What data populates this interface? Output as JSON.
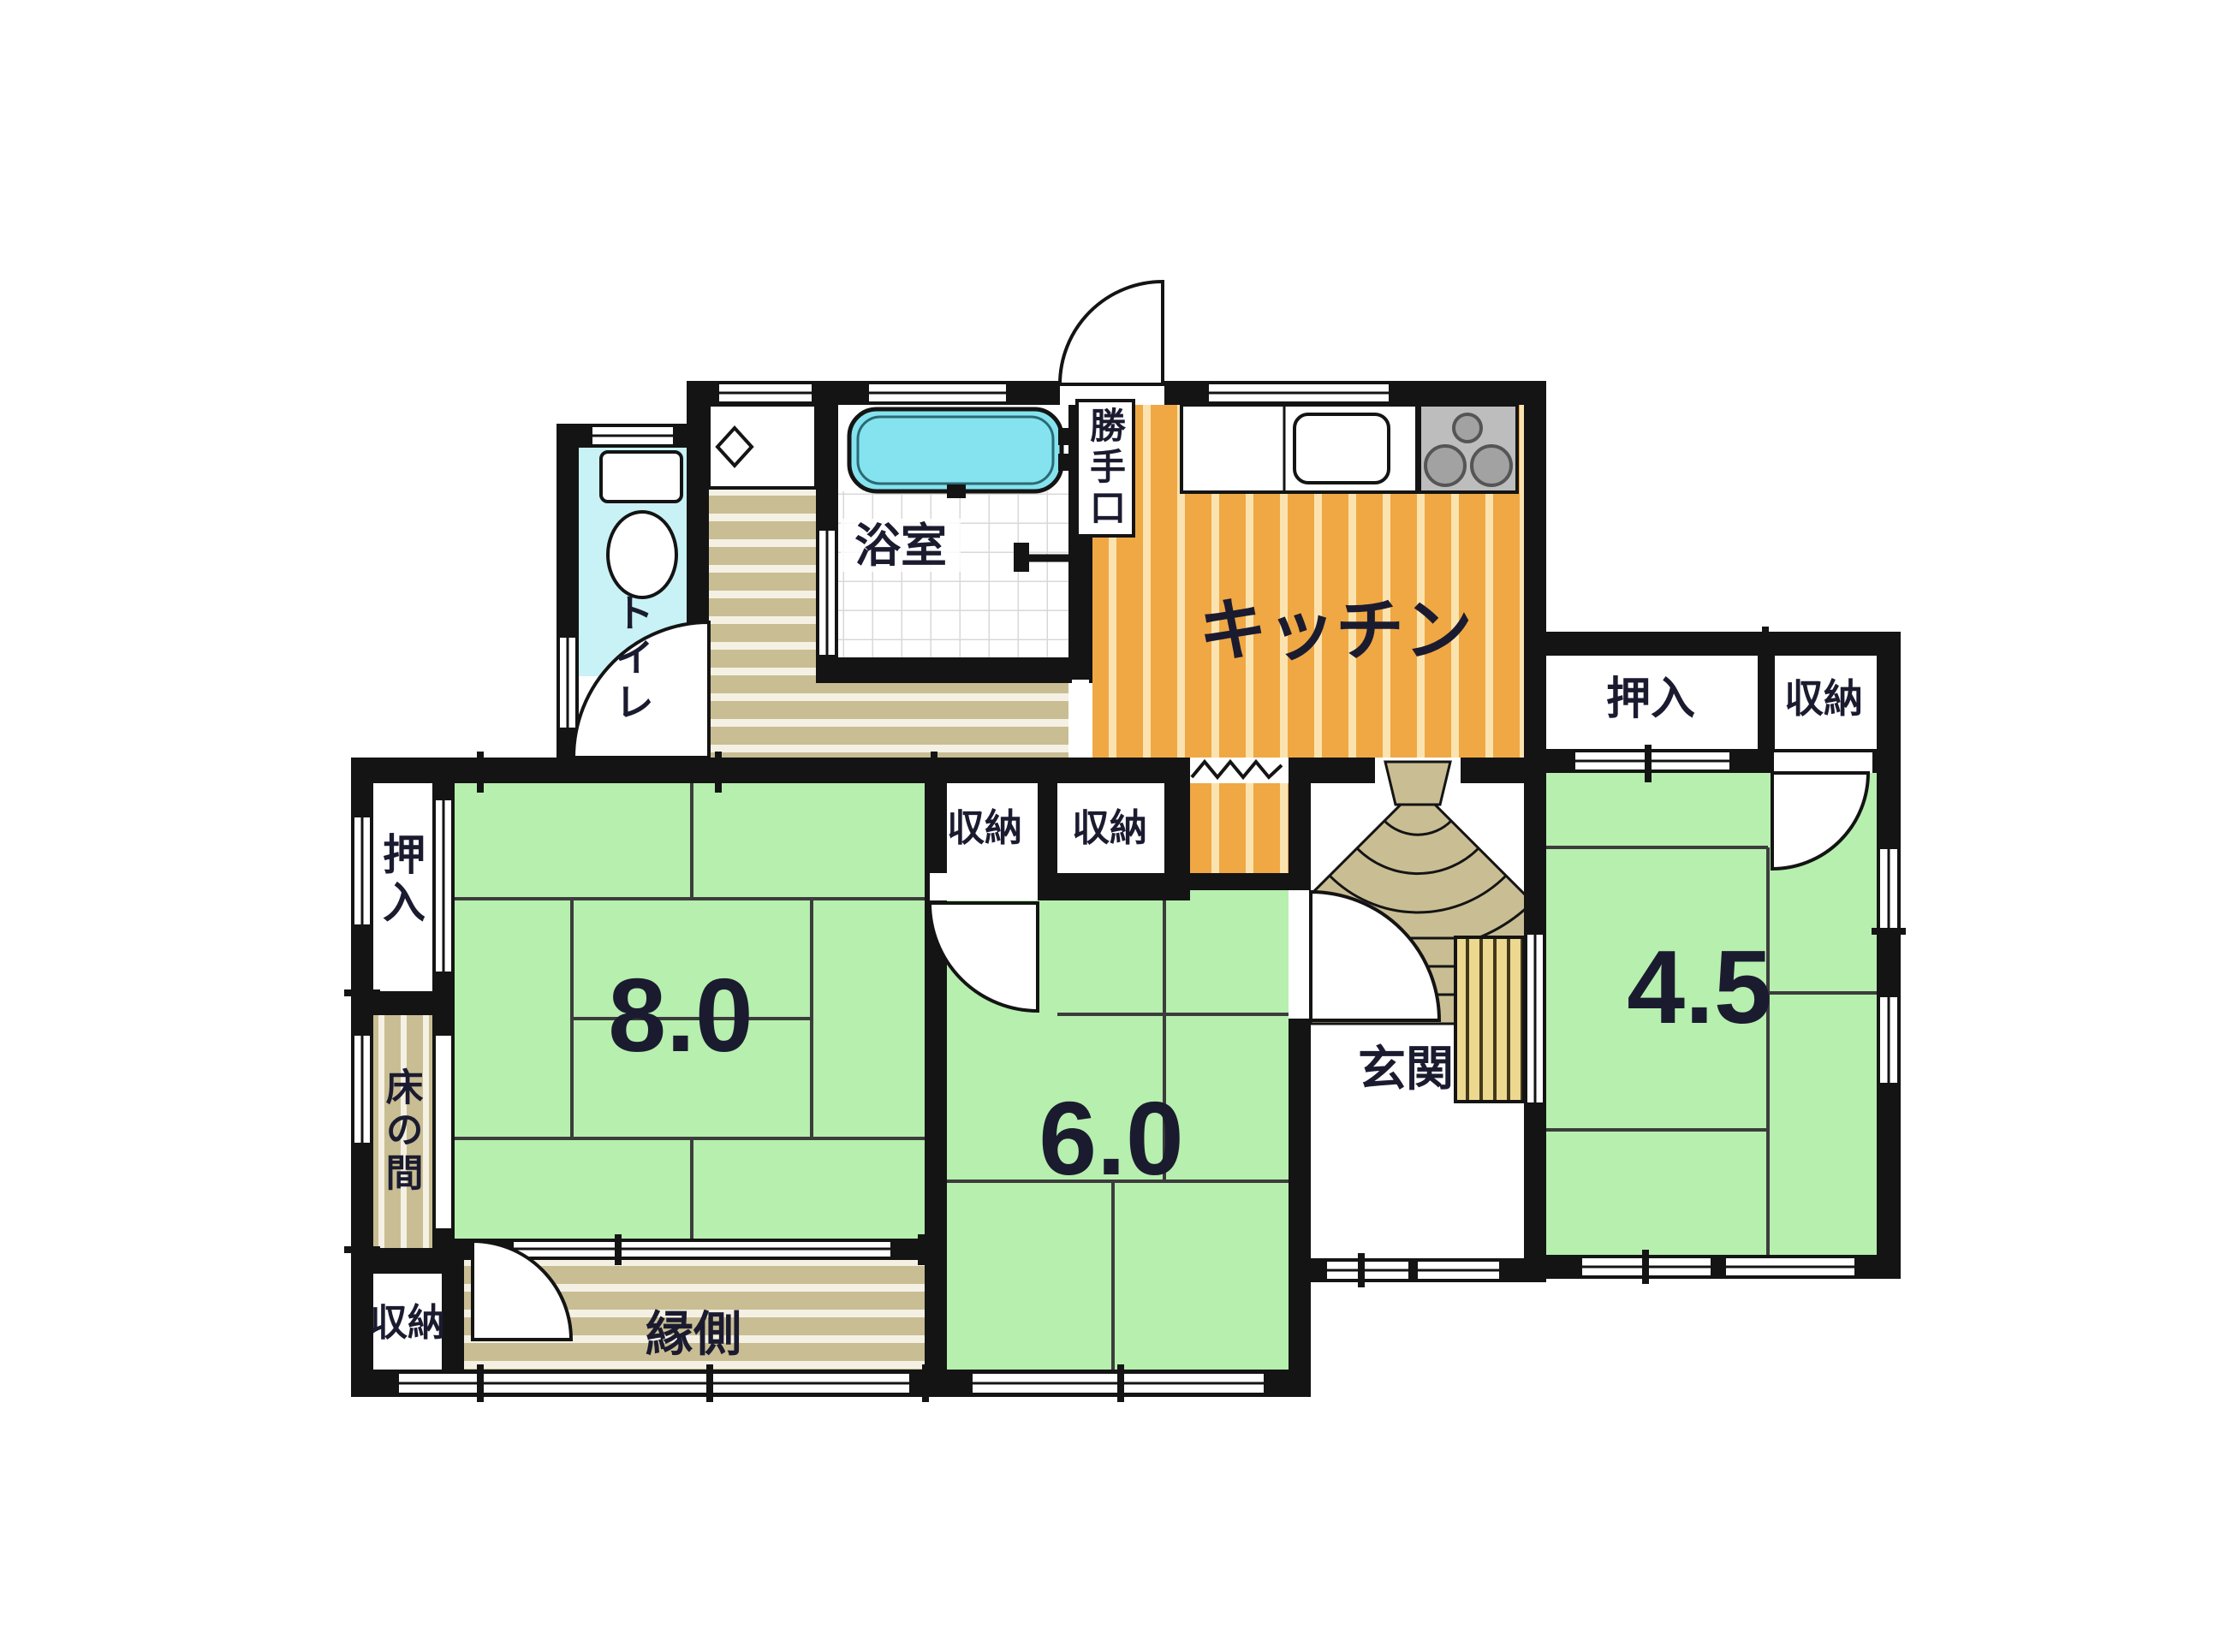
{
  "plan": {
    "type": "japanese-house-floor-plan",
    "rooms": {
      "toilet": {
        "label": "トイレ"
      },
      "bathroom": {
        "label": "浴室"
      },
      "kitchen": {
        "label": "キッチン"
      },
      "back_door": {
        "label": "勝手口"
      },
      "hall_closet_1": {
        "label": "収納"
      },
      "hall_closet_2": {
        "label": "収納"
      },
      "tatami_8": {
        "label": "8.0"
      },
      "tatami_6": {
        "label": "6.0"
      },
      "tatami_45": {
        "label": "4.5"
      },
      "oshiire_west": {
        "label": "押入"
      },
      "tokonoma": {
        "label": "床の間"
      },
      "closet_southwest": {
        "label": "収納"
      },
      "engawa": {
        "label": "縁側"
      },
      "genkan": {
        "label": "玄関"
      },
      "oshiire_east": {
        "label": "押入"
      },
      "closet_east": {
        "label": "収納"
      }
    },
    "colors": {
      "wall": "#141414",
      "tatami": "#b6efae",
      "tatami_line": "#3c3c3c",
      "kitchen": "#f0a844",
      "kitchen_stripe": "#fbe3b0",
      "wood": "#c9bd93",
      "wood_stripe": "#f4f1e4",
      "toilet": "#c9f2f6",
      "tub": "#84e3ee",
      "tile_line": "#d8d8d8",
      "stove": "#bdbdbd",
      "burner": "#a2a2a2",
      "mat": "#ecd98f",
      "mat_line": "#44381a",
      "text": "#1b1b30",
      "paper": "#ffffff"
    }
  }
}
